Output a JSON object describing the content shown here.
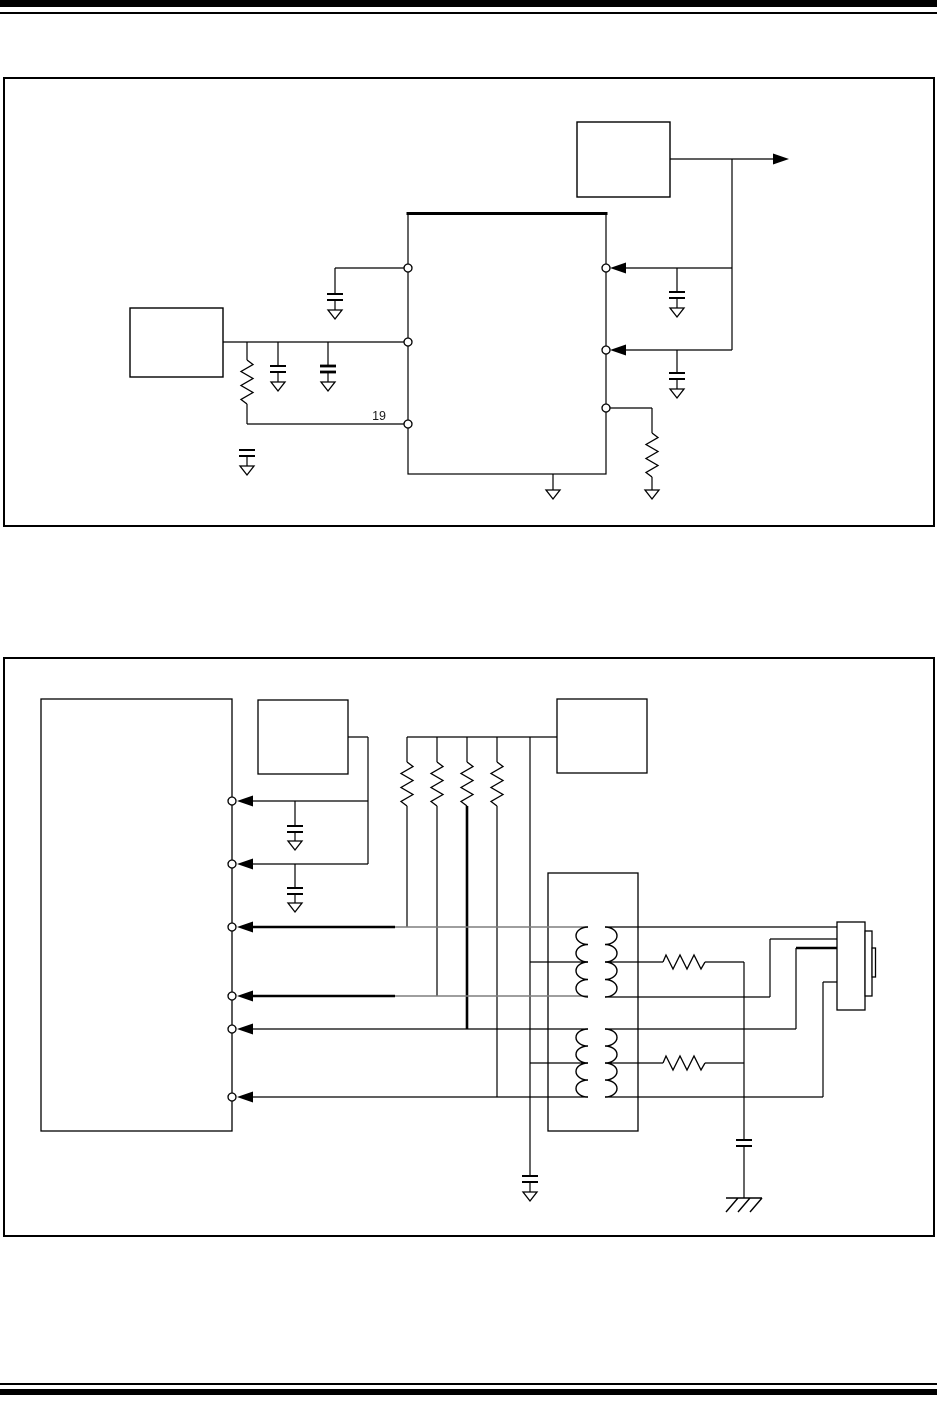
{
  "colors": {
    "ink": "#000000",
    "paper": "#ffffff",
    "muted_line": "#7f7f7f"
  },
  "figure1": {
    "pin_label_19": "19"
  },
  "symbols": {
    "ground": "earth-ground-triangle",
    "chassis_ground": "chassis-ground-hatched",
    "capacitor": "capacitor-two-plate",
    "resistor": "resistor-zigzag",
    "transformer": "dual-winding-transformer",
    "connector": "modular-jack-connector",
    "pin": "pin-circle",
    "signal_arrow": "solid-triangle-arrow"
  }
}
